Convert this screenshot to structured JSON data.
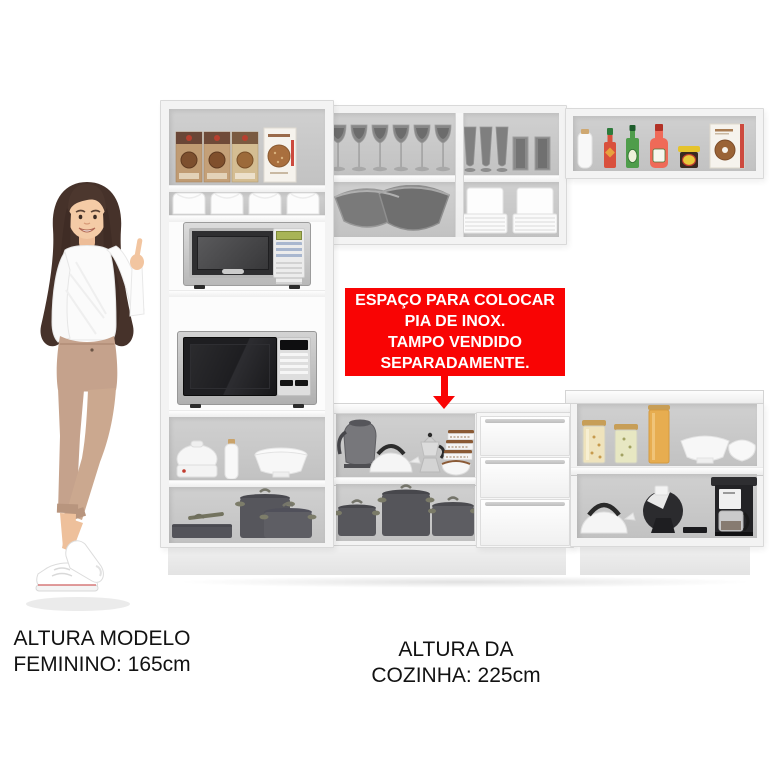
{
  "annotation": {
    "sink_note": {
      "lines": [
        "ESPAÇO PARA COLOCAR",
        "PIA DE INOX.",
        "TAMPO VENDIDO",
        "SEPARADAMENTE."
      ],
      "bg_color": "#f90404",
      "text_color": "#ffffff",
      "arrow": "red-down-arrow"
    },
    "model_height_label": {
      "line1": "ALTURA MODELO",
      "line2": "FEMININO: 165cm"
    },
    "kitchen_height_label": {
      "line1": "ALTURA DA",
      "line2": "COZINHA: 225cm"
    }
  },
  "colors": {
    "accent_red": "#f90404",
    "cabinet_white": "#f3f3f3",
    "interior_gray": "#c8c8c8",
    "cookware_gray": "#57575c",
    "hair_brown": "#46322a",
    "pants_tan": "#c5a28c"
  },
  "scene": {
    "figure": "woman-pointing-at-kitchen",
    "kitchen_sections": {
      "tall_cabinet_items": [
        "cereal-boxes",
        "food-storage-bins",
        "silver-microwave",
        "black-microwave",
        "sandwich-maker",
        "milk-bottle",
        "soup-tureen",
        "roasting-pan",
        "stock-pots"
      ],
      "upper_cabinet_items": [
        "wine-glasses",
        "glass-bowls",
        "pilsner-glasses",
        "tumbler-glasses",
        "plate-stacks"
      ],
      "upper_shelf_items": [
        "white-bottle",
        "hot-sauce-bottle",
        "green-sauce-bottle",
        "ketchup-bottle",
        "condiment-jar",
        "cookie-box"
      ],
      "counter_items": [
        "electric-kettle",
        "whistling-kettle",
        "moka-pot",
        "canister-set",
        "serving-bowl",
        "stock-pots",
        "drawers"
      ],
      "right_counter_items": [
        "grain-jars",
        "spaghetti-jar",
        "serving-bowls",
        "whistling-kettle",
        "espresso-machine",
        "drip-coffee-maker"
      ]
    }
  }
}
